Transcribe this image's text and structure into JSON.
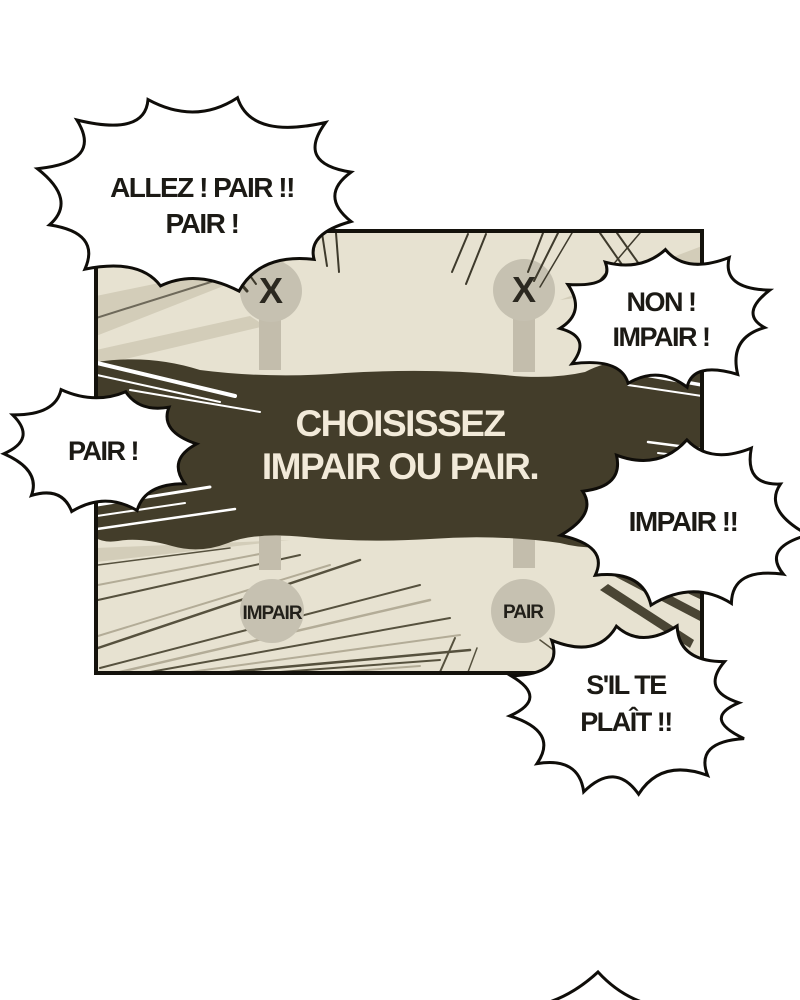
{
  "comic": {
    "instruction_banner": {
      "line1": "CHOISISSEZ",
      "line2": "IMPAIR OU PAIR."
    },
    "choices": {
      "top_left": "X",
      "top_right": "X",
      "bottom_left": "IMPAIR",
      "bottom_right": "PAIR"
    },
    "speech_bubbles": [
      {
        "name": "allez-pair",
        "lines": [
          "ALLEZ ! PAIR !!",
          "PAIR !"
        ]
      },
      {
        "name": "non-impair",
        "lines": [
          "NON !",
          "IMPAIR !"
        ]
      },
      {
        "name": "pair",
        "lines": [
          "PAIR !"
        ]
      },
      {
        "name": "impair",
        "lines": [
          "IMPAIR !!"
        ]
      },
      {
        "name": "sil-te-plait",
        "lines": [
          "S'IL TE",
          "PLAÎT !!"
        ]
      }
    ],
    "colors": {
      "page_bg": "#ffffff",
      "panel_bg": "#e7e2d1",
      "banner_bg": "#433d2a",
      "banner_text": "#f2ead9",
      "chip_fill": "#c6c1b1",
      "outline": "#14120c",
      "bubble_fill": "#ffffff"
    }
  }
}
